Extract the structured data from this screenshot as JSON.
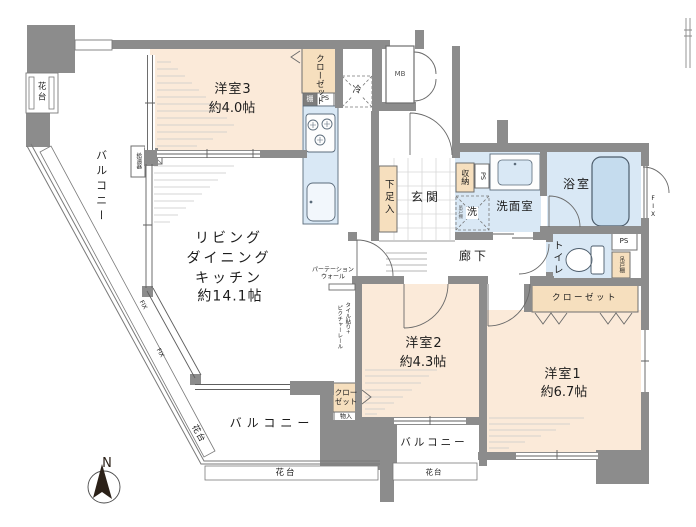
{
  "rooms": {
    "room3": {
      "name": "洋室3",
      "size": "約4.0帖"
    },
    "room2": {
      "name": "洋室2",
      "size": "約4.3帖"
    },
    "room1": {
      "name": "洋室1",
      "size": "約6.7帖"
    },
    "ldk": {
      "line1": "リビング",
      "line2": "ダイニング",
      "line3": "キッチン",
      "size": "約14.1帖"
    },
    "genkan": "玄関",
    "corridor": "廊下",
    "washroom": "洗面室",
    "bathroom": "浴室",
    "toilet": "トイレ"
  },
  "storage": {
    "closet": "クローゼット",
    "shoe_box": "下足入",
    "storage_box": "収納",
    "shelf": "棚",
    "hanging_cupboard": "吊戸棚",
    "small_storage": "物入"
  },
  "balcony": {
    "balcony": "バルコニー",
    "flower_stand": "花台"
  },
  "fixtures": {
    "refrigerator": "冷",
    "washer": "洗",
    "meter_box": "MB",
    "pipe_space": "PS",
    "water_heater": "給湯器"
  },
  "windows": {
    "fix": "FIX"
  },
  "notes": {
    "partition1": "パーテーション",
    "partition2": "ウォール",
    "tile_rail_right": "タイル貼り+",
    "tile_rail_left": "ピクチャーレール"
  },
  "compass": {
    "north": "N"
  },
  "colors": {
    "wall": "#8c8c8c",
    "room_beige": "#fbead9",
    "closet_beige": "#f6dfbe",
    "water_blue": "#d9e8f5",
    "tub_blue": "#c5dcee"
  }
}
